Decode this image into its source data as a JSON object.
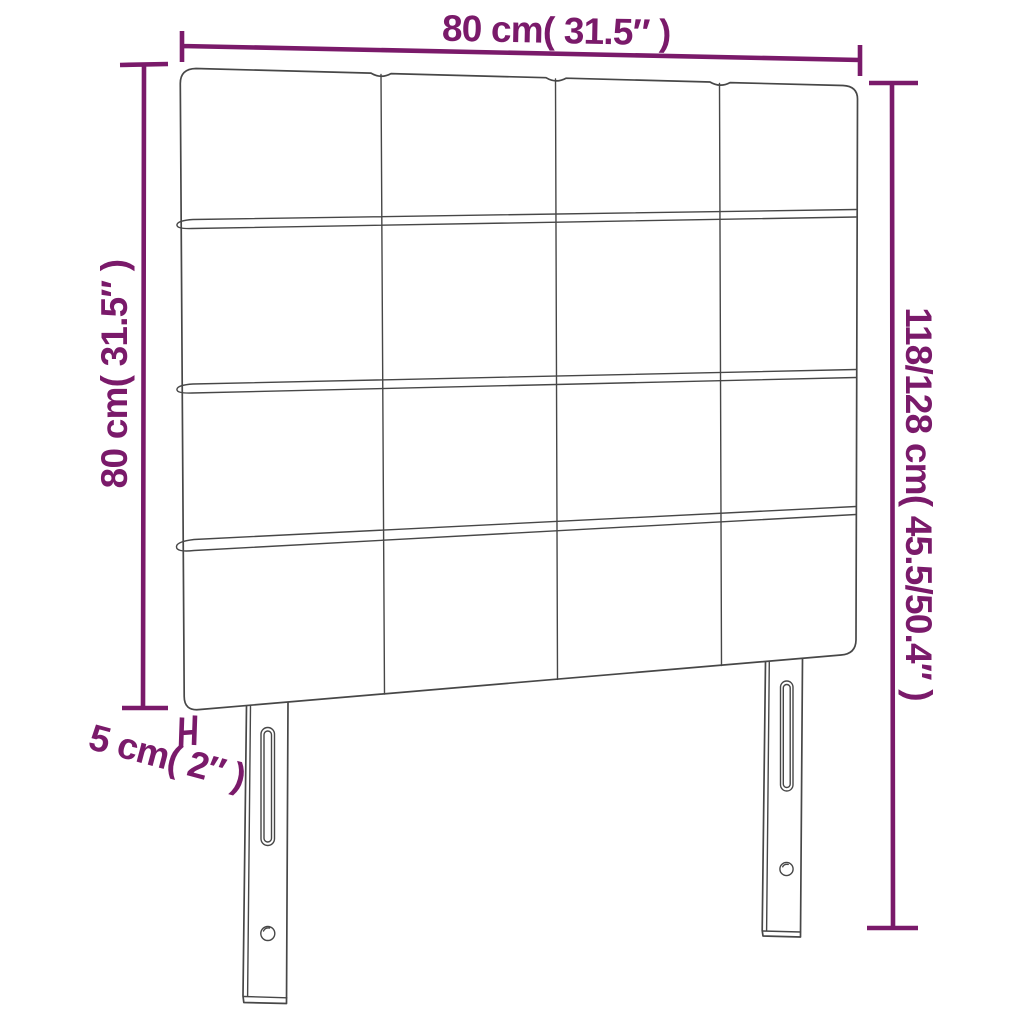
{
  "diagram": {
    "labels": {
      "width_top": "80 cm( 31.5″ )",
      "height_left": "80 cm( 31.5″ )",
      "height_right": "118/128 cm( 45.5/50.4″ )",
      "thickness": "5 cm( 2″ )"
    },
    "colors": {
      "dimension_lines": "#7A1A6A",
      "sketch_lines": "#474747",
      "background": "#FFFFFF"
    },
    "grid": {
      "columns": 4,
      "rows": 4
    }
  }
}
